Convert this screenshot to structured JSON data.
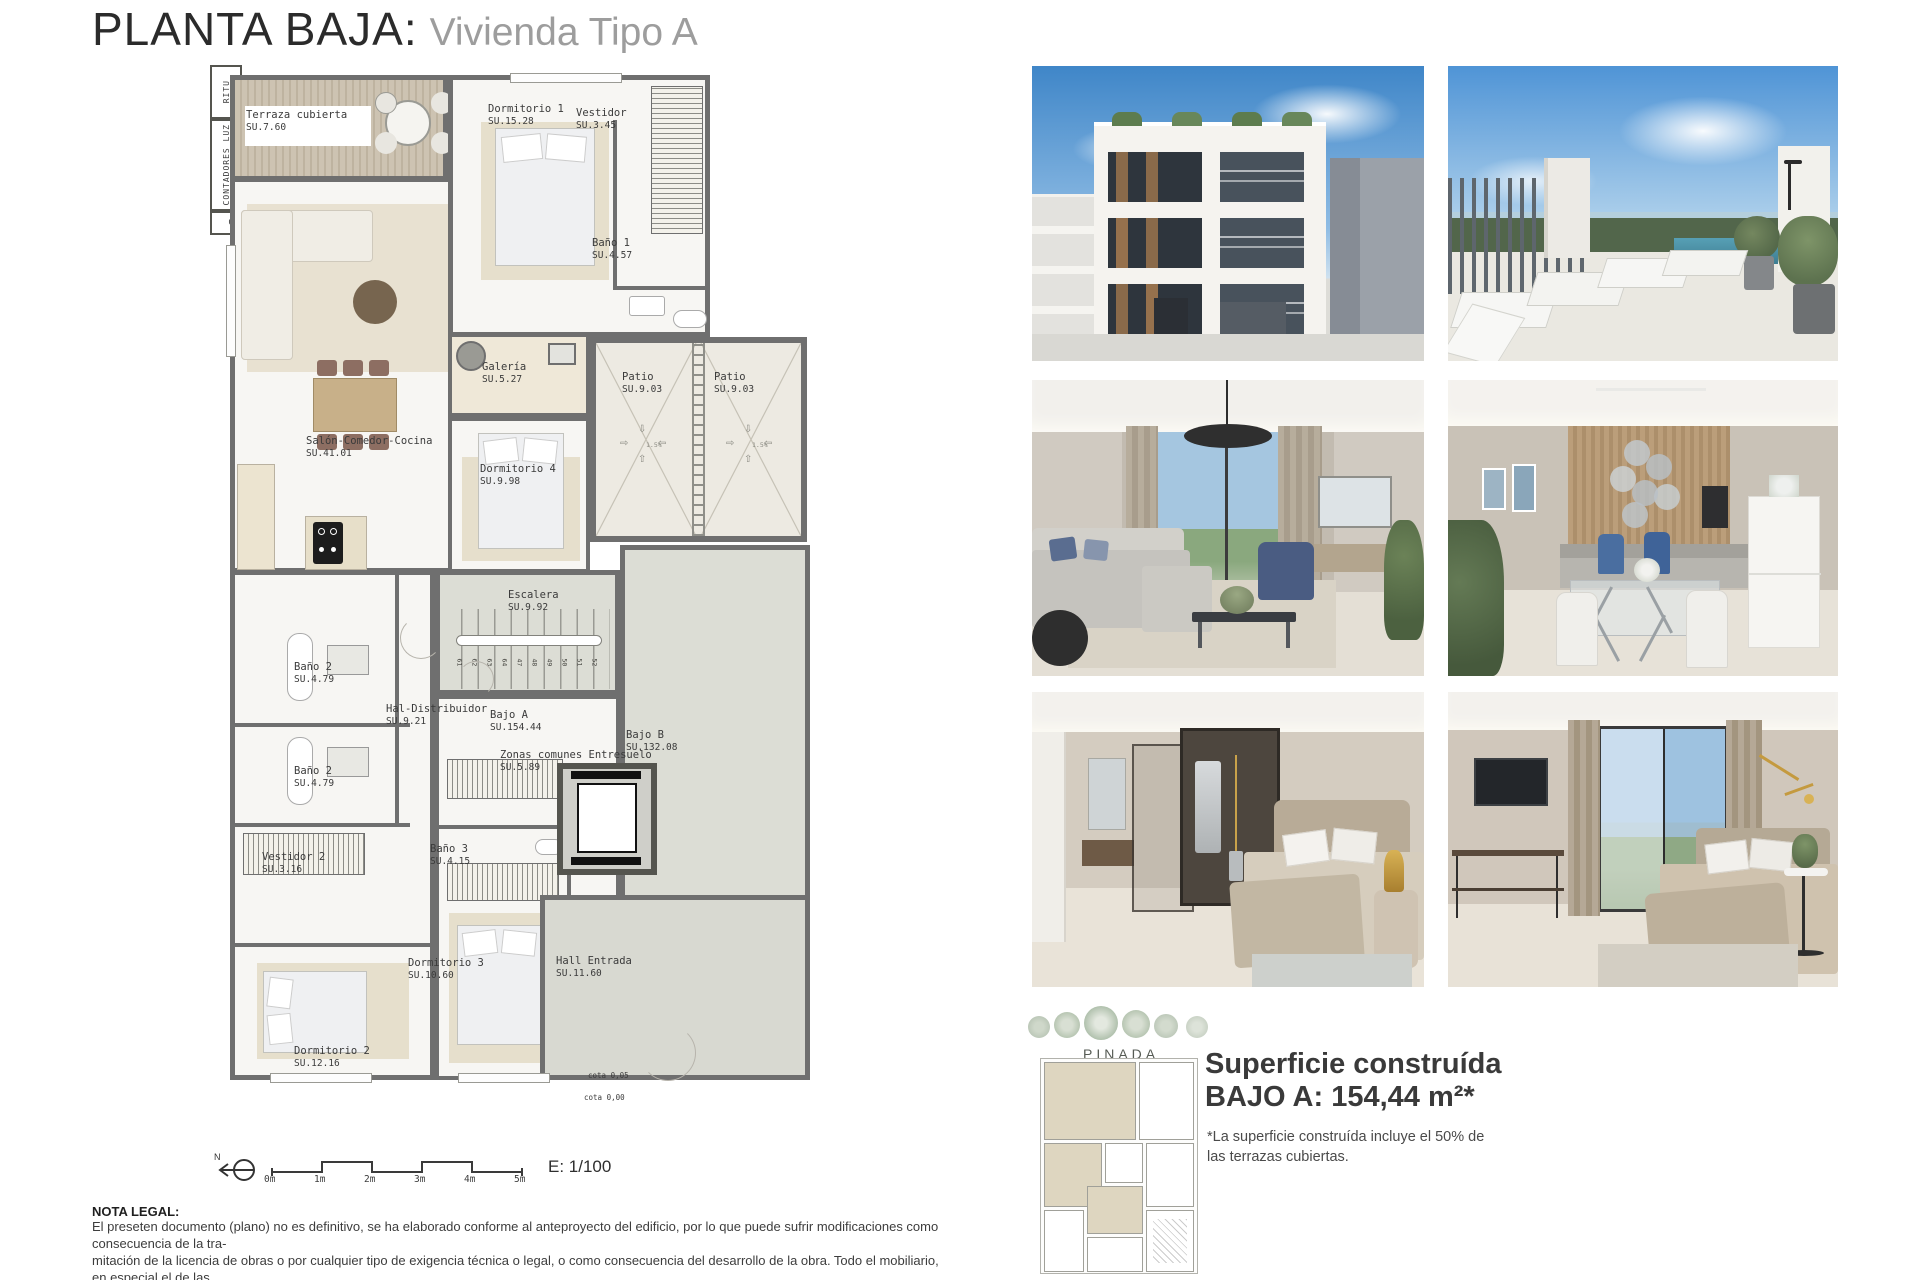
{
  "title": {
    "main": "PLANTA BAJA:",
    "sub": "Vivienda Tipo A"
  },
  "plan": {
    "rooms": [
      {
        "name": "Terraza cubierta",
        "area": "SU.7.60"
      },
      {
        "name": "Dormitorio 1",
        "area": "SU.15.28"
      },
      {
        "name": "Vestidor",
        "area": "SU.3.45"
      },
      {
        "name": "Baño 1",
        "area": "SU.4.57"
      },
      {
        "name": "Galería",
        "area": "SU.5.27"
      },
      {
        "name": "Salón-Comedor-Cocina",
        "area": "SU.41.01"
      },
      {
        "name": "Dormitorio 4",
        "area": "SU.9.98"
      },
      {
        "name": "Patio",
        "area": "SU.9.03"
      },
      {
        "name": "Patio",
        "area": "SU.9.03"
      },
      {
        "name": "Escalera",
        "area": "SU.9.92"
      },
      {
        "name": "Baño 2",
        "area": "SU.4.79"
      },
      {
        "name": "Baño 2",
        "area": "SU.4.79"
      },
      {
        "name": "Hal-Distribuidor",
        "area": "SU.9.21"
      },
      {
        "name": "Bajo A",
        "area": "SU.154.44"
      },
      {
        "name": "Bajo B",
        "area": "SU.132.08"
      },
      {
        "name": "Zonas comunes Entresuelo",
        "area": "SU.5.89"
      },
      {
        "name": "Vestidor 2",
        "area": "SU.3.16"
      },
      {
        "name": "Baño 3",
        "area": "SU.4.15"
      },
      {
        "name": "Dormitorio 3",
        "area": "SU.10.60"
      },
      {
        "name": "Dormitorio 2",
        "area": "SU.12.16"
      },
      {
        "name": "Hall Entrada",
        "area": "SU.11.60"
      }
    ],
    "stair_numbers": [
      "61",
      "62",
      "63",
      "64",
      "47",
      "48",
      "49",
      "50",
      "51",
      "52"
    ],
    "slope": "1.5%",
    "icons": {
      "arrow_up": "⇧",
      "arrow_down": "⇩",
      "arrow_left": "⇦",
      "arrow_right": "⇨"
    },
    "utilities": {
      "ritu": "RITU",
      "contadores": "CONTADORES LUZ",
      "cgp": "CGP"
    },
    "cotas": {
      "high": "cota 0,05",
      "low": "cota 0,00"
    }
  },
  "scale_bar": {
    "north": "N",
    "ticks": [
      "0m",
      "1m",
      "2m",
      "3m",
      "4m",
      "5m"
    ],
    "scale": "E: 1/100"
  },
  "gallery": {
    "images": [
      {
        "name": "building-facade-render"
      },
      {
        "name": "rooftop-terrace-pool-render"
      },
      {
        "name": "living-room-render"
      },
      {
        "name": "dining-kitchen-render"
      },
      {
        "name": "bedroom-dressing-render"
      },
      {
        "name": "bedroom-window-render"
      }
    ]
  },
  "summary": {
    "brand": "PINADA",
    "line1": "Superficie construída",
    "line2": "BAJO A: 154,44 m²*",
    "foot1": "*La superficie construída incluye el 50% de",
    "foot2": "las  terrazas cubiertas."
  },
  "legal": {
    "heading": "NOTA LEGAL:",
    "lines": [
      "El preseten documento (plano) no es definitivo, se ha elaborado conforme al anteproyecto del edificio, por lo que puede sufrir modificaciones como consecuencia de la tra-",
      "mitación de la licencia de obras o por cualquier tipo de exigencia técnica o legal, o como consecuencia del desarrollo de la obra. Todo el mobiliario, en especial el de las",
      "cocinas y baños, están dibujados como ejemplos de distribución. Sólo se entregará el mobiliario y electrodomésticos que se especifiquen en la memoria comercial definitiva.",
      "Es un plano meramente informativo, sin contenido contractual."
    ]
  },
  "colors": {
    "wall": "#6f6f6f",
    "common_floor": "#dcddd5",
    "patio_floor": "#edeae2",
    "terrace_wood": "#c7bca9",
    "sky": "#5b9bd5"
  }
}
